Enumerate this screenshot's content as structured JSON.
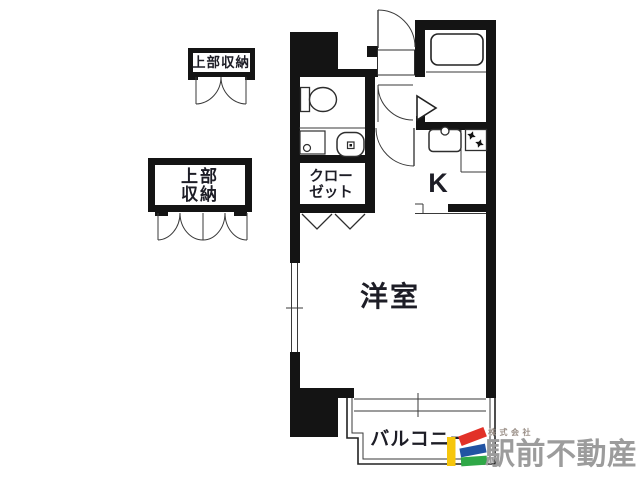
{
  "floor_plan": {
    "rooms": {
      "upper_storage_small": {
        "label": "上部収納"
      },
      "upper_storage_large": {
        "label_line1": "上部",
        "label_line2": "収納"
      },
      "closet": {
        "label_line1": "クロー",
        "label_line2": "ゼット"
      },
      "kitchen": {
        "label": "K"
      },
      "western_room": {
        "label": "洋室"
      },
      "balcony": {
        "label": "バルコニー"
      }
    },
    "colors": {
      "wall": "#141414",
      "label_text": "#1d1d26"
    }
  },
  "branding": {
    "company_prefix": "株式会社",
    "company_name": "駅前不動産",
    "colors": {
      "bar_yellow": "#F6C60C",
      "bar_red": "#E23128",
      "bar_blue": "#2153A3",
      "bar_green": "#2FA847",
      "company_text": "#9c9c9c",
      "prefix_text": "#9a8f87"
    }
  }
}
